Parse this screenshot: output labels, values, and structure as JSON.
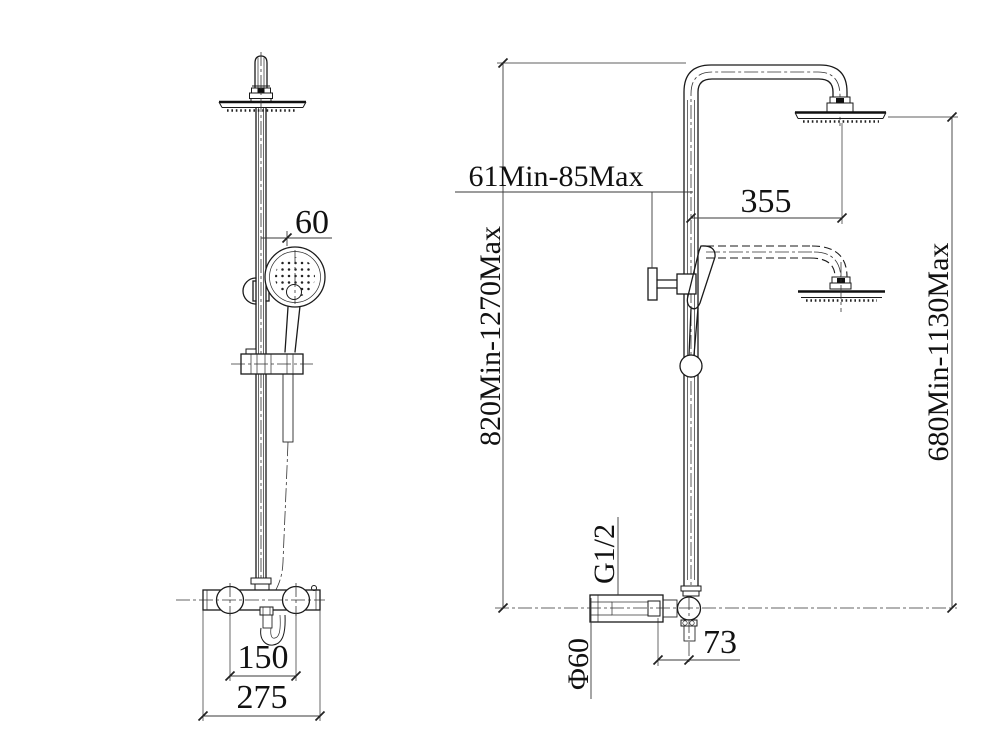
{
  "colors": {
    "line": "#1a1a1a",
    "background": "#ffffff"
  },
  "dims": {
    "hand_shower_offset": "60",
    "inlet_spacing": "150",
    "valve_width": "275",
    "wall_clearance": "61Min-85Max",
    "arm_reach": "355",
    "column_height": "820Min-1270Max",
    "lower_head_height": "680Min-1130Max",
    "inlet_thread": "G1/2",
    "trim_diameter": "Φ60",
    "outlet_offset": "73"
  }
}
